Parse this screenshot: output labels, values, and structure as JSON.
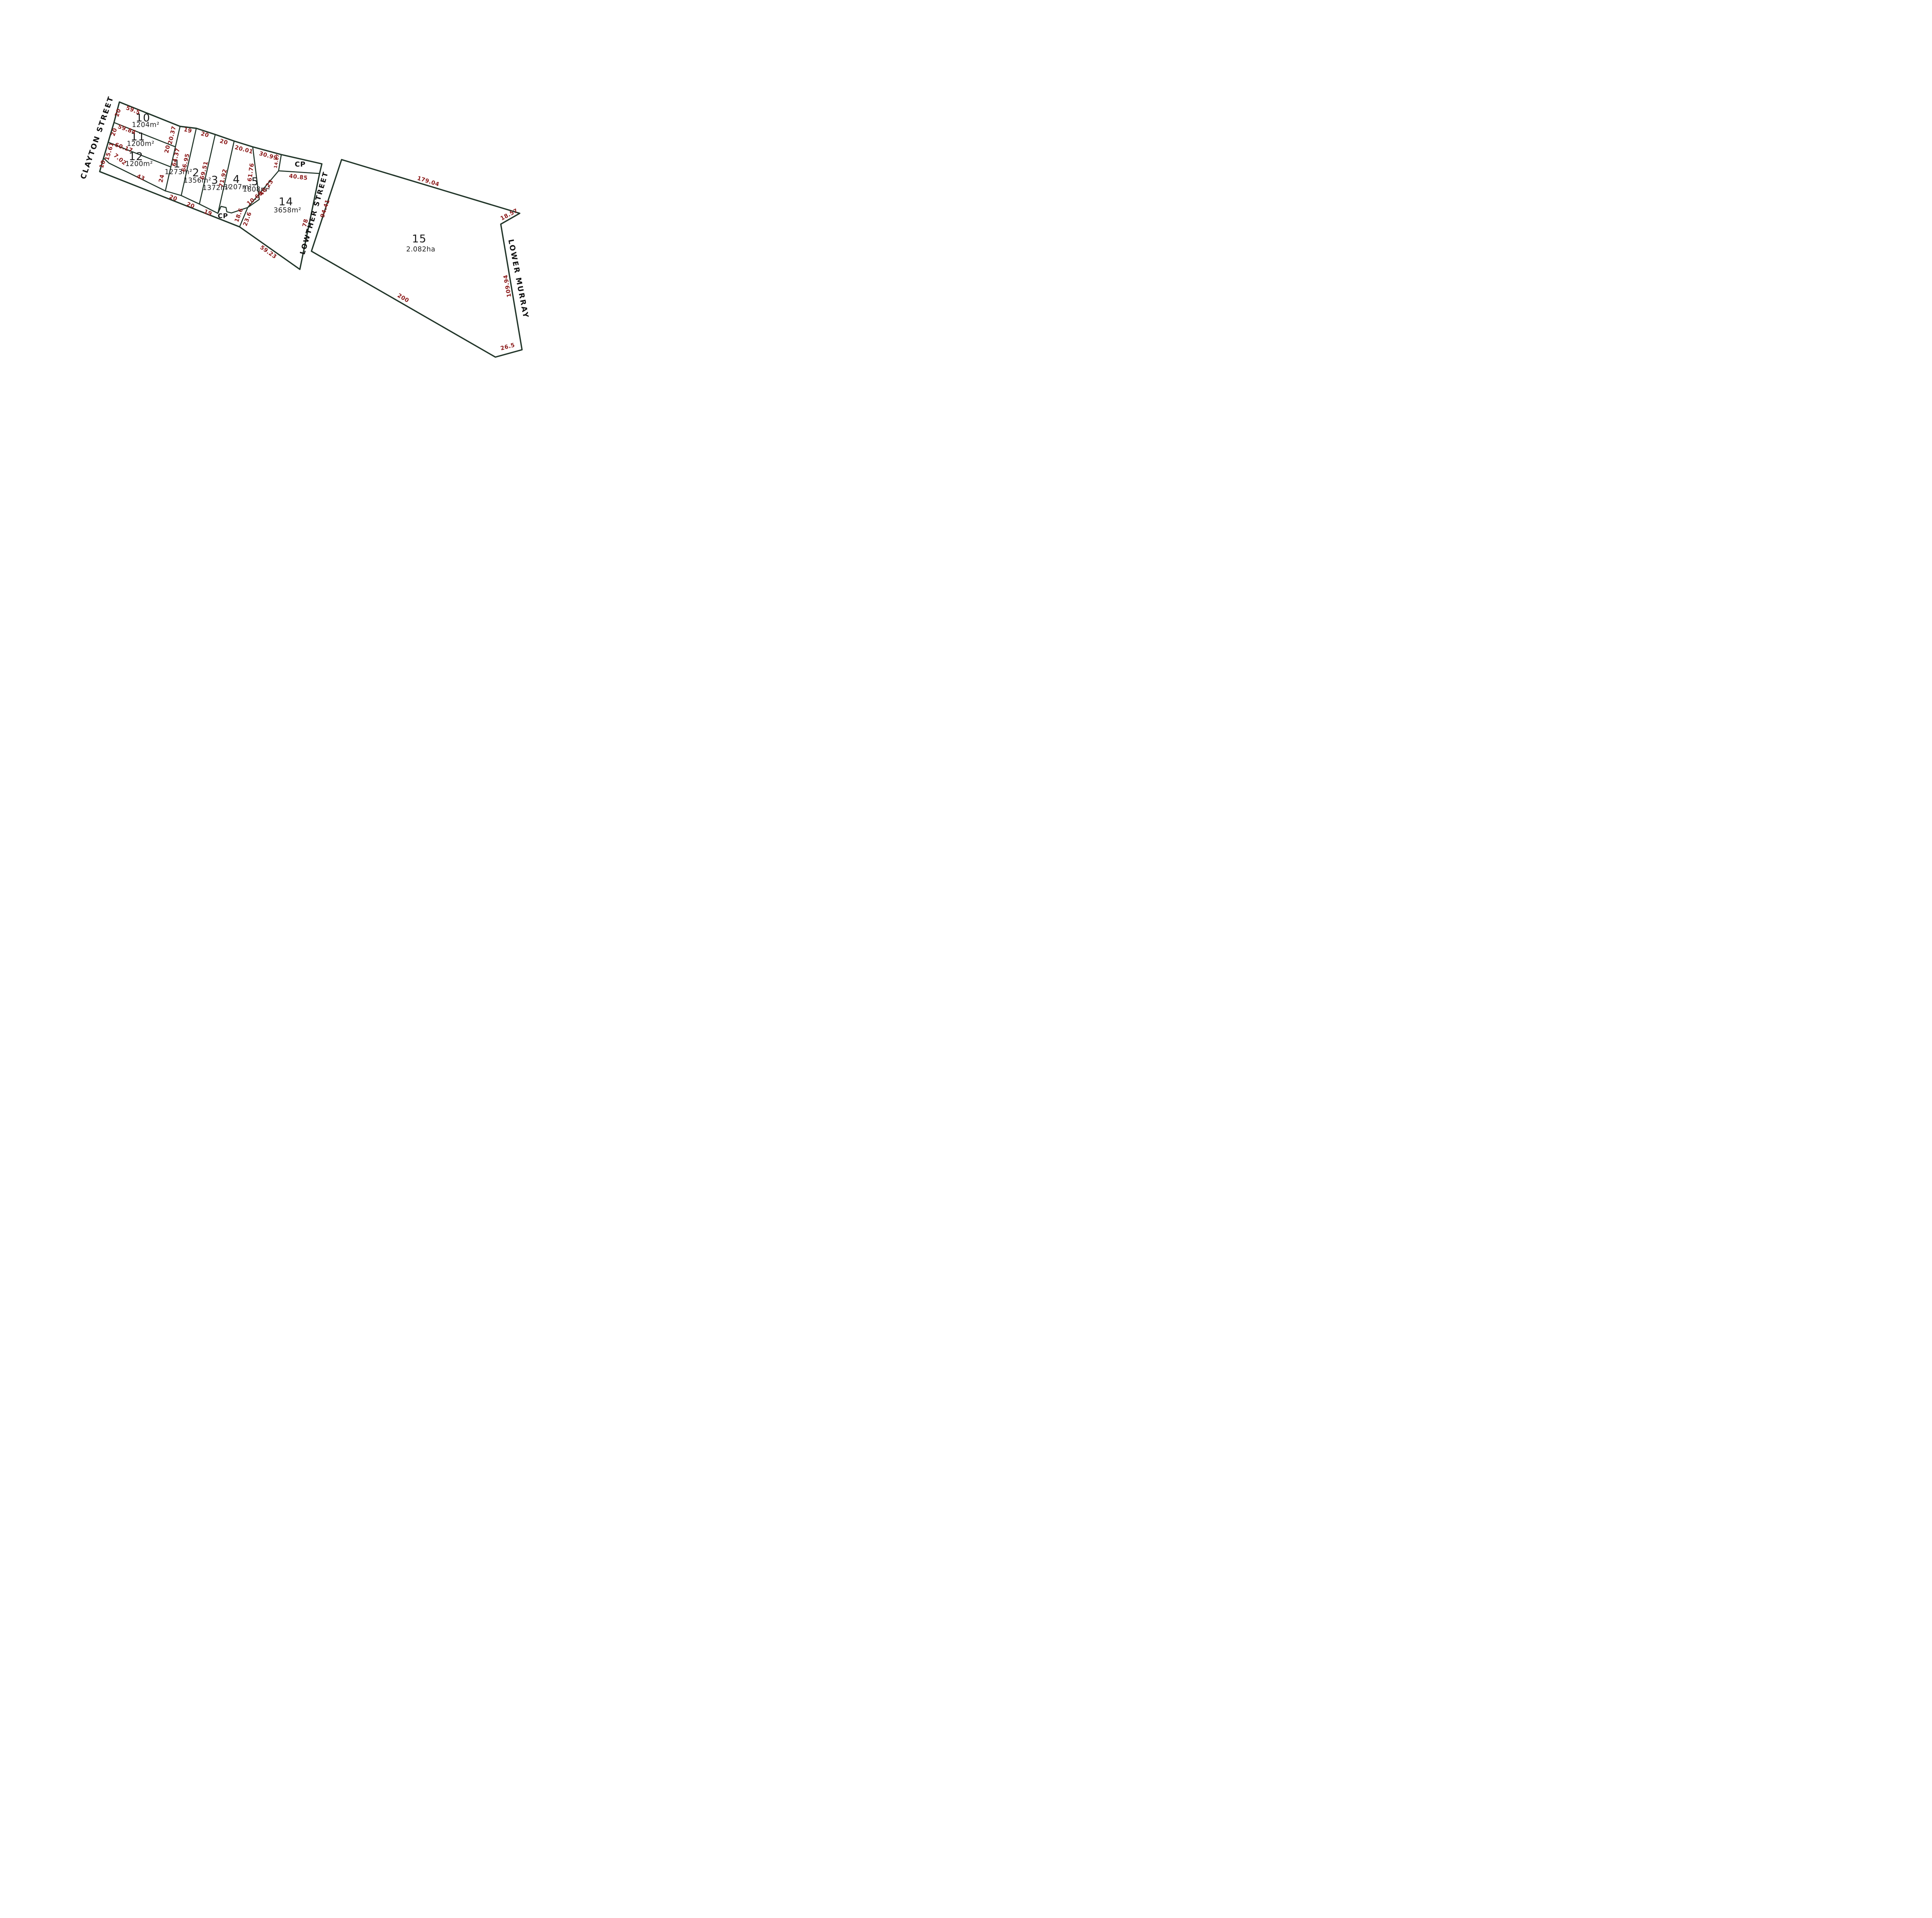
{
  "plan": {
    "streets": {
      "clayton": "CLAYTON STREET",
      "lowther": "LOWTHER STREET",
      "lower_murray": "LOWER MURRAY"
    },
    "common_property": "CP",
    "lots": [
      {
        "number": "10",
        "area": "1204m²"
      },
      {
        "number": "11",
        "area": "1200m²"
      },
      {
        "number": "12",
        "area": "1200m²"
      },
      {
        "number": "1",
        "area": "1273m²"
      },
      {
        "number": "2",
        "area": "1356m²"
      },
      {
        "number": "3",
        "area": "1372m²"
      },
      {
        "number": "4",
        "area": "1207m²"
      },
      {
        "number": "5",
        "area": "1808m²"
      },
      {
        "number": "14",
        "area": "3658m²"
      },
      {
        "number": "15",
        "area": "2.082ha"
      }
    ],
    "dimensions": {
      "lot10_frontage": "20",
      "lot10_top": "59.5",
      "lot10_east": "20.37",
      "lot11_frontage": "20",
      "lot11_top": "59.84",
      "lot11_east": "20",
      "lot12_frontage": "15.61",
      "lot12_top": "60.17",
      "lot12_jog": "7.02",
      "lot12_bottom": "43",
      "lot12_east": "24",
      "road_frontage": "10",
      "lot1_top": "19",
      "lot1_west": "64.37",
      "lot1_east": "66.95",
      "lot1_bottom": "20",
      "lot2_top": "20",
      "lot2_east": "69.51",
      "lot2_bottom": "20",
      "lot3_top": "20",
      "lot3_east": "71.92",
      "lot3_bottom": "19",
      "lot4_top": "20.01",
      "lot4_east": "61.76",
      "lot5_top": "30.99",
      "lot5_bottom": "10.66",
      "cp_west": "14.67",
      "cp_south": "40.85",
      "lot14_west_upper": "40.23",
      "cp_notch_east": "18.6",
      "lot14_west_lower": "23.6",
      "lot14_south": "59.23",
      "lot14_east": "78",
      "lowther_frontage": "94.41",
      "lot15_top": "179.04",
      "lot15_notch": "18.57",
      "lot15_east": "109.94",
      "lot15_south_east": "26.5",
      "lot15_bottom": "200"
    },
    "colors": {
      "boundary_line": "#213529",
      "dimension_text": "#8c1b1b",
      "label_text": "#1a1a1a",
      "background": "#ffffff"
    }
  }
}
